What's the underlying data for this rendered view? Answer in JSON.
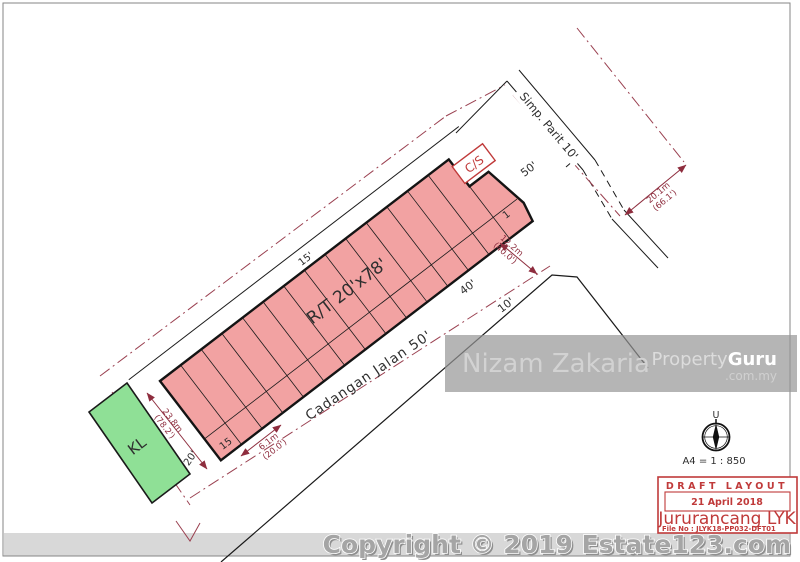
{
  "page": {
    "copyright": "Copyright © 2019 Estate123.com"
  },
  "plan": {
    "block_label": "R/T 20'x78'",
    "lot_first": "1",
    "lot_last": "15",
    "strip_label": "15'",
    "front_label": "20'",
    "road_main": "Cadangan  Jalan  50'",
    "road_side": "Simp.  Parit 10'",
    "cs_label": "C/S",
    "kl_label": "KL",
    "label_50": "50'",
    "label_40": "40'",
    "label_10": "10'",
    "colors": {
      "lot_fill": "#f2a2a2",
      "kl_fill": "#8fe096",
      "dim_red": "#8e2d3e",
      "boundary_red": "#9a4050"
    },
    "dims": {
      "depth_m": "23.8m",
      "depth_ft": "(78.2')",
      "lot_w_m": "6.1m",
      "lot_w_ft": "(20.0')",
      "corner_m": "12.2m",
      "corner_ft": "(40.0')",
      "road_m": "20.1m",
      "road_ft": "(66.1')"
    }
  },
  "compass": {
    "north": "U",
    "scale": "A4 = 1 : 850"
  },
  "watermark": {
    "name": "Nizam Zakaria",
    "brand_1": "Property",
    "brand_2": "Guru",
    "brand_sub": ".com.my"
  },
  "stamp": {
    "title": "DRAFT LAYOUT",
    "date": "21 April 2018",
    "company": "Jururancang LYK",
    "file_no": "File No : JLYK18-PP032-DFT01"
  }
}
